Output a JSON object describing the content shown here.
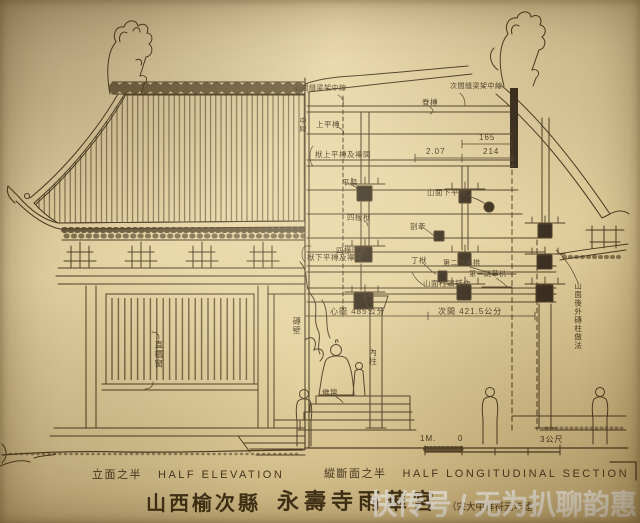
{
  "drawing": {
    "captions": {
      "elevation_zh": "立面之半",
      "elevation_en": "HALF ELEVATION",
      "section_zh": "縱斷面之半",
      "section_en": "HALF LONGITUDINAL SECTION"
    },
    "title": {
      "location": "山西榆次縣",
      "name": "永壽寺雨華宮",
      "note": "（宋大中祥符元年建）"
    },
    "scale_bar": {
      "meter": "1M.",
      "zero": "0",
      "end": "3公尺"
    },
    "dimensions": {
      "rafter_1": "2.07",
      "rafter_2": "165",
      "rafter_3": "214",
      "bay_center": "心間 485公分",
      "bay_side": "次間 421.5公分"
    },
    "annotations": {
      "center_frame_centerline": "心間縫梁架中線",
      "ridge_purlin": "脊槫",
      "side_frame_centerline": "次間縫梁架中線",
      "centerline": "中線",
      "upper_purlin": "上平槫",
      "purlin_above_beam": "栿上平槫及襻間",
      "collar_beam": "平梁",
      "gable_lower_purlin": "山面下平槫",
      "four_rafter_beam": "四椽栿",
      "tie_beam": "剳牽",
      "purlin_below_beam": "栿下平槫及襻間",
      "four_rafter_beam_soffit": "四椽明栿",
      "ding_beam": "丁栿",
      "second_jump_bracket": "第二跳華栱",
      "first_jump_bracket": "第一跳華栱",
      "gable_capital_bracket": "山面柱頭鋪作",
      "brick_wall": "磚壁",
      "lattice_window": "直櫺窗",
      "inner_column": "內柱",
      "buddha_altar": "佛壇",
      "gable_note": "山面後外磚柱做法"
    },
    "watermark": "快传号 / 无为扒聊韵惠"
  },
  "colors": {
    "paper": "#e7d5a5",
    "ink": "#4a3a22",
    "watermark": "#ffffff"
  }
}
